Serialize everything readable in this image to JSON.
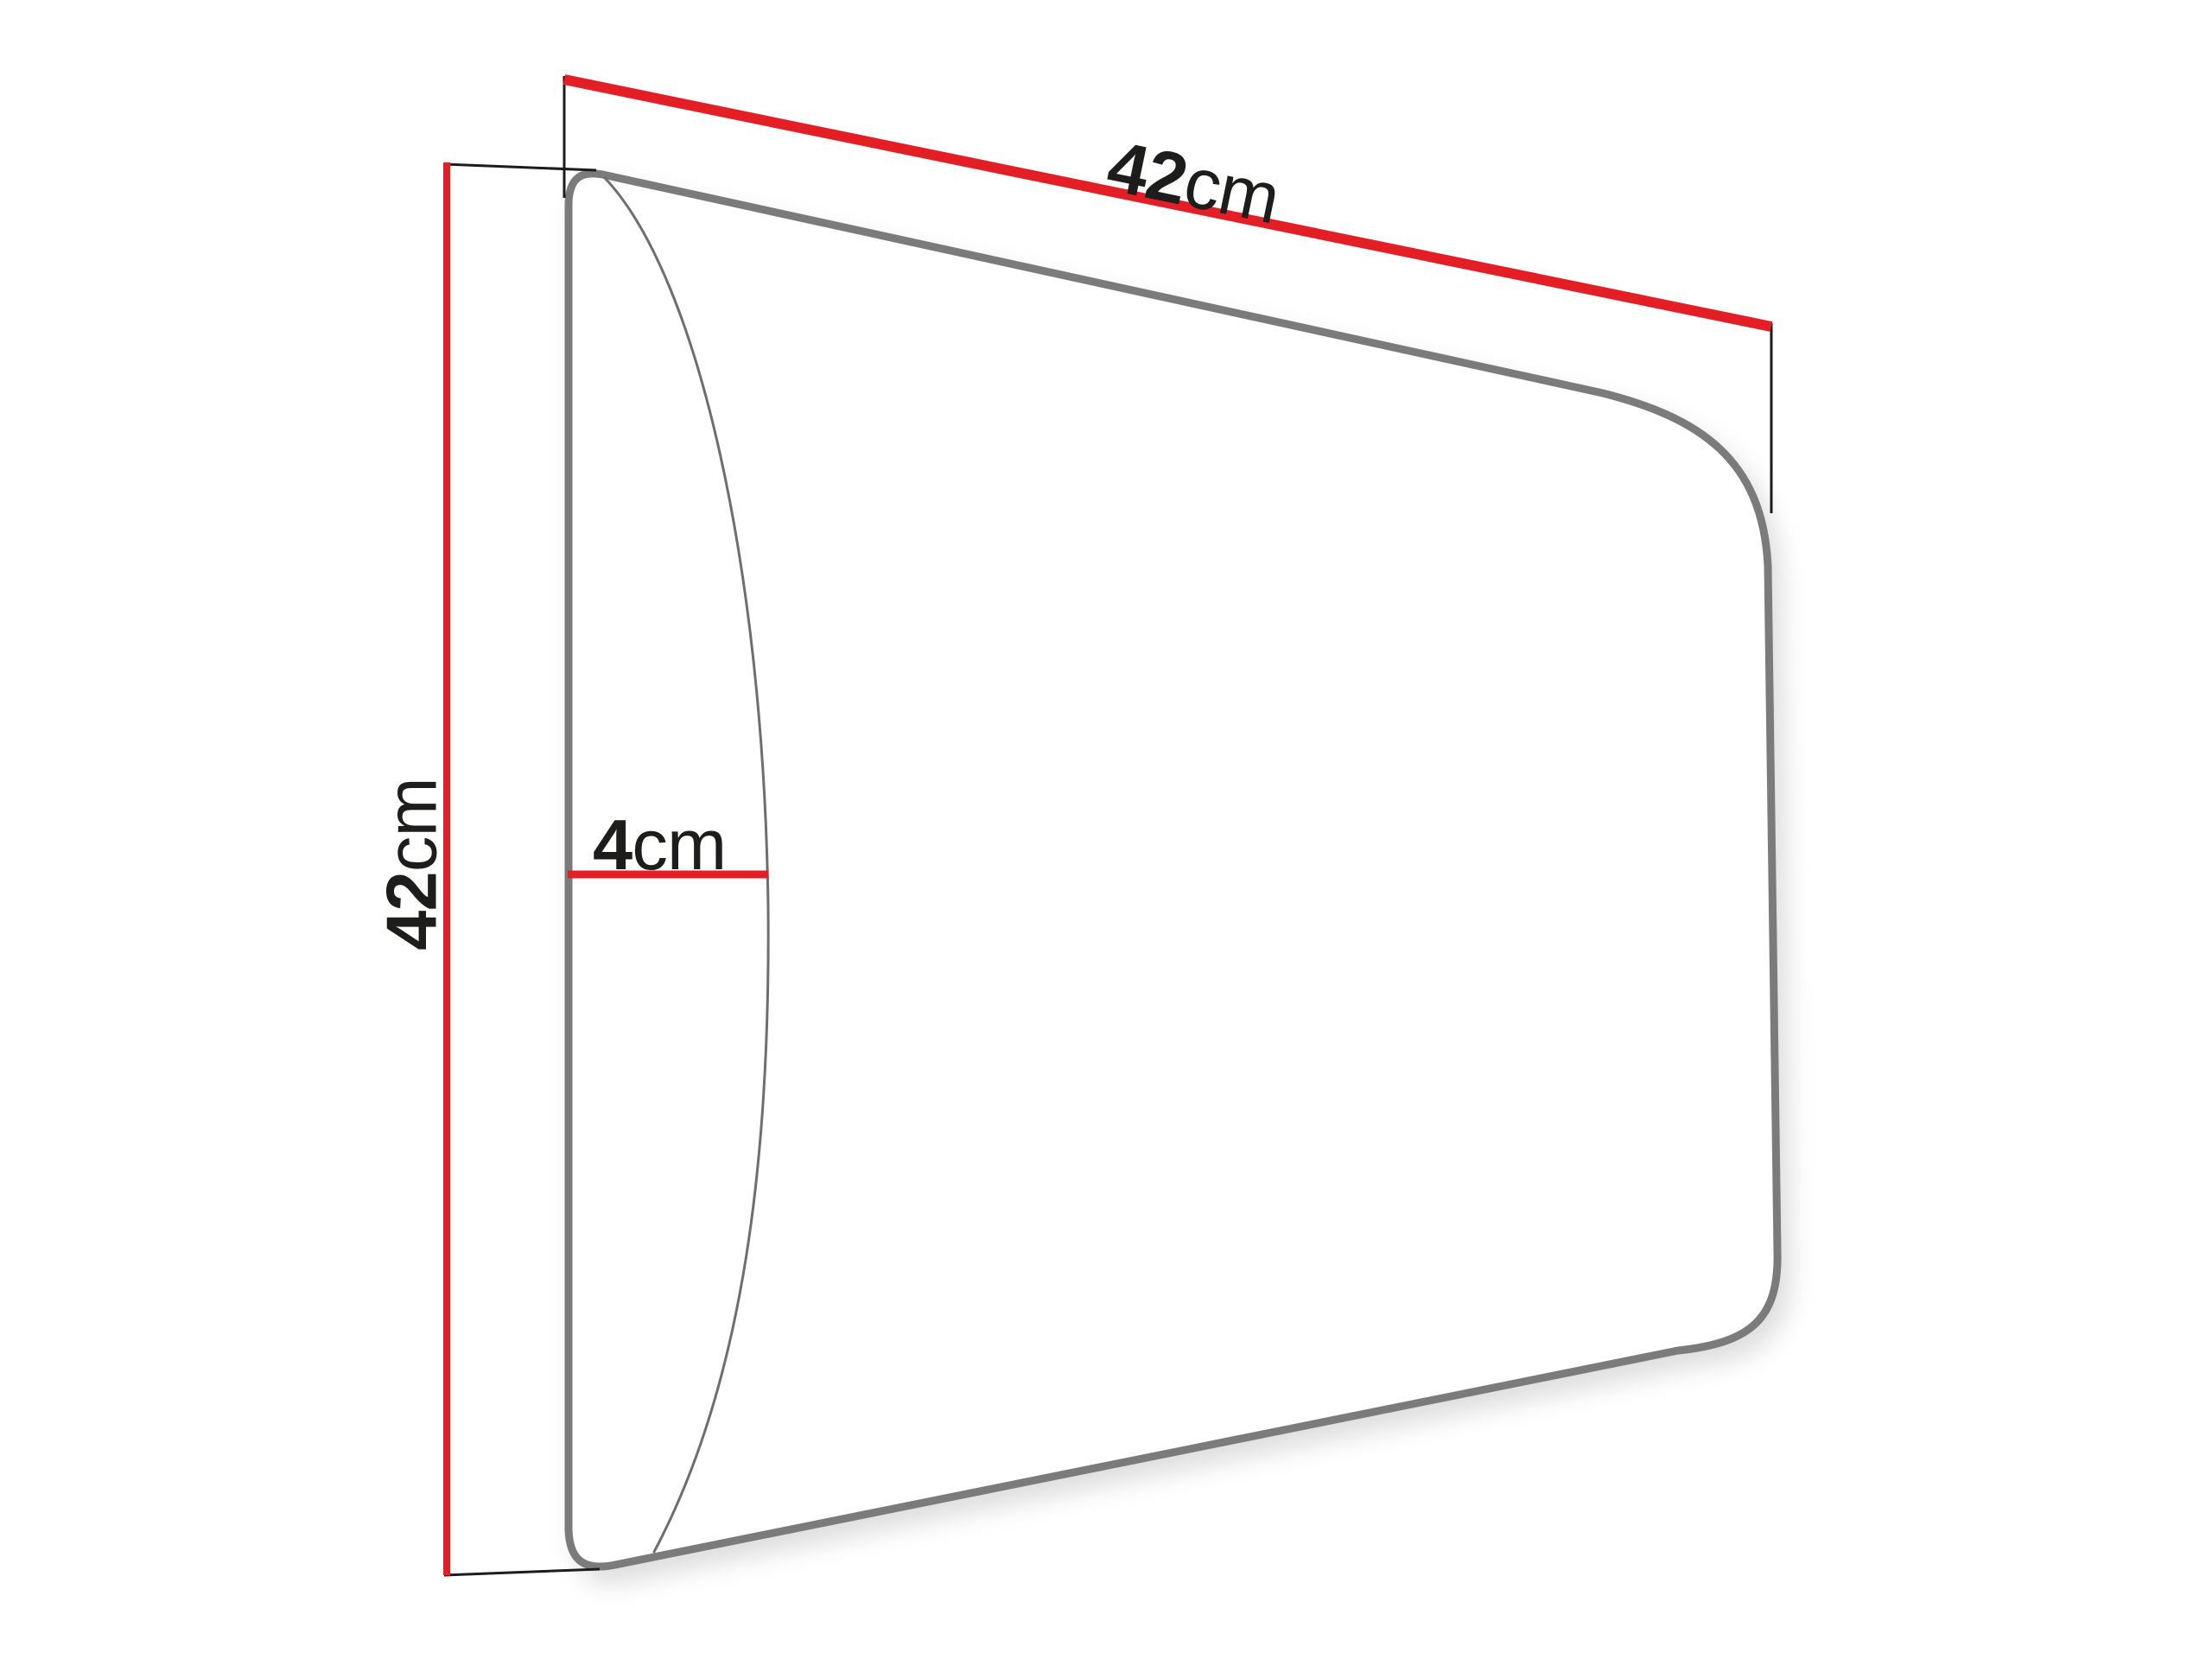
{
  "diagram": {
    "type": "product-dimension-drawing",
    "subject": "upholstered wall panel, perspective side view",
    "dimensions": {
      "width": {
        "value": "42",
        "unit": "cm"
      },
      "height": {
        "value": "42",
        "unit": "cm"
      },
      "depth": {
        "value": "4",
        "unit": "cm"
      }
    }
  },
  "colors": {
    "dimension_red": "#e31e25",
    "outline_gray": "#7b7b7b",
    "front_edge_gray": "#6e6e6e",
    "extension_black": "#1c1c1c",
    "text_black": "#1d1d1b",
    "panel_fill": "#ffffff",
    "background": "#ffffff"
  }
}
